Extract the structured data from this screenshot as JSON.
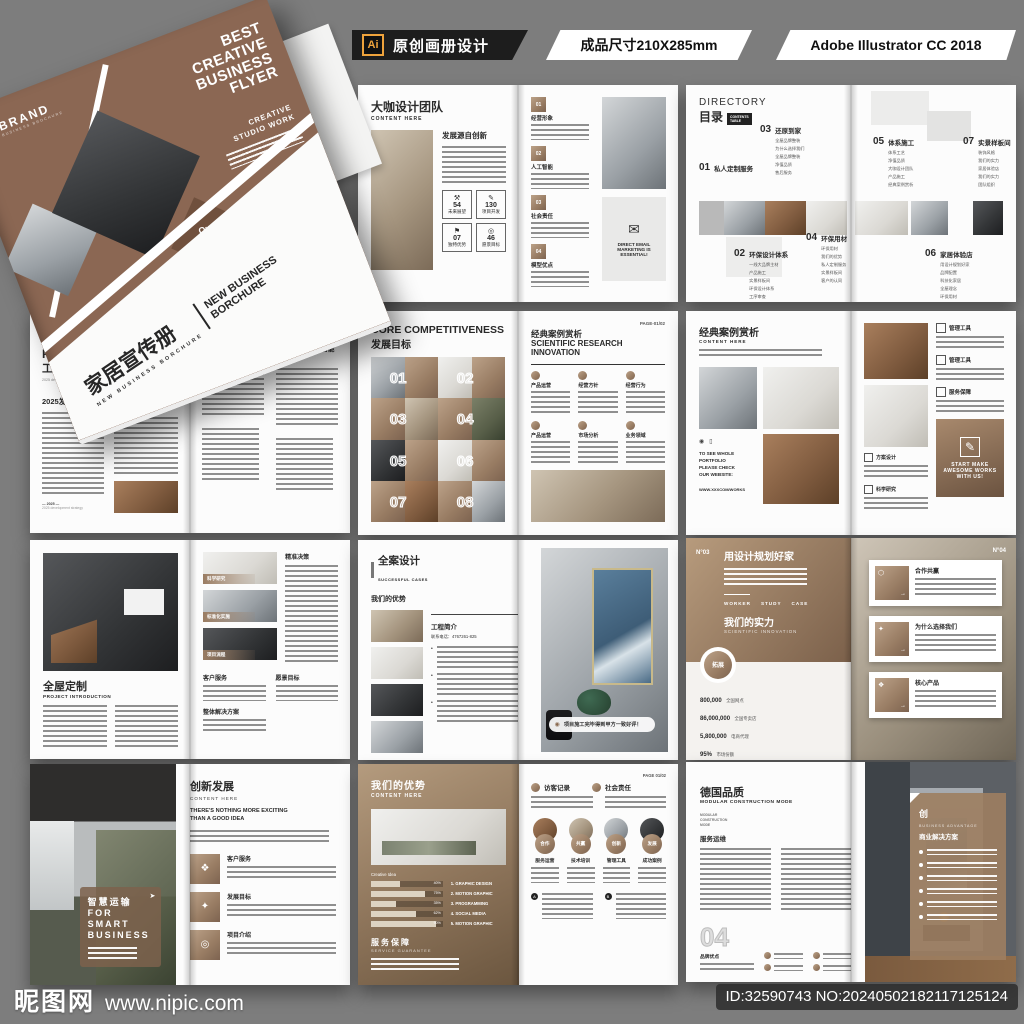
{
  "header": {
    "ai_badge": "Ai",
    "product": "原创画册设计",
    "size": "成品尺寸210X285mm",
    "software": "Adobe Illustrator CC 2018"
  },
  "watermark": {
    "site_name": "昵图网",
    "site_url": "www.nipic.com",
    "image_id": "ID:32590743 NO:20240502182117125124"
  },
  "icons": {
    "hexagon": "⬡",
    "email": "✉",
    "pencil": "✎",
    "tools": "⚒",
    "flag": "⚑",
    "target": "◎",
    "plane": "➤",
    "blocks": "❖",
    "spark": "✦",
    "arrow": "→",
    "camera": "◉",
    "doc": "▯",
    "check": "◉"
  },
  "cover": {
    "brand": "BRAND",
    "brand_sub": "BUSINESS BROCHURE",
    "headline": "BEST\nCREATIVE\nBUSINESS\nFLYER",
    "studio": "CREATIVE\nSTUDIO WORK",
    "service_tag": "Our\nService",
    "title_cn": "家居宣传册",
    "title_en": "NEW BUSINESS BORCHURE",
    "side_title": "NEW BUSINESS\nBORCHURE"
  },
  "team": {
    "title": "大咖设计团队",
    "subtitle": "CONTENT HERE",
    "section": "发展源自创新",
    "stats": [
      {
        "num": "54",
        "label": "未来展望"
      },
      {
        "num": "130",
        "label": "项目开发"
      },
      {
        "num": "07",
        "label": "独特优势"
      },
      {
        "num": "46",
        "label": "愿景目标"
      }
    ],
    "items": [
      {
        "no": "01",
        "label": "经营形象"
      },
      {
        "no": "02",
        "label": "人工智能"
      },
      {
        "no": "03",
        "label": "社会责任"
      },
      {
        "no": "04",
        "label": "模型优点"
      }
    ],
    "email_note": "DIRECT EMAIL\nMARKETING IS\nESSENTIAL!"
  },
  "directory": {
    "title_en": "DIRECTORY",
    "title_cn": "目录",
    "subtitle": "CONTENTS\nTABLE",
    "e01": {
      "no": "01",
      "title": "私人定制服务"
    },
    "e02": {
      "no": "02",
      "title": "环保设计体系",
      "items": [
        "一线大品牌主材",
        "产品施工",
        "实景样板间",
        "环保设计体系",
        "工序审查"
      ]
    },
    "e03": {
      "no": "03",
      "title": "还原到家",
      "items": [
        "全屋品牌整装",
        "为什么选择我们",
        "全屋品牌整装",
        "净值品质",
        "售后服务"
      ]
    },
    "e04": {
      "no": "04",
      "title": "环保用材",
      "items": [
        "环保用材",
        "我们的优势",
        "私人定制服务",
        "实景样板间",
        "客户的认同"
      ]
    },
    "e05": {
      "no": "05",
      "title": "体系施工",
      "items": [
        "体系工艺",
        "净值品质",
        "大咖设计团队",
        "产品施工",
        "经典案例赏析"
      ]
    },
    "e06": {
      "no": "06",
      "title": "家居体验店",
      "items": [
        "用设计规划好家",
        "品牌配置",
        "科技化家居",
        "全屋理念",
        "环保用材"
      ]
    },
    "e07": {
      "no": "07",
      "title": "实景样板间",
      "items": [
        "装饰风格",
        "我们的实力",
        "家居体验店",
        "我们的实力",
        "团队组织"
      ]
    }
  },
  "profile": {
    "brand": "BRAND",
    "title_en": "GROUP\nPROFILE",
    "title_cn": "工业智能",
    "subtitle": "2025 development strategy",
    "h1": "2025发展战略",
    "h2": "经营理念",
    "footer_note": "2025 development strategy",
    "right_h1": "互联网智能世界",
    "right_h2": "构建万物互联的智能世界"
  },
  "core": {
    "title_en": "CORE COMPETITIVENESS",
    "title_cn": "发展目标",
    "numbers": [
      "01",
      "02",
      "03",
      "04",
      "05",
      "06",
      "07",
      "08"
    ],
    "page_no": "PAGE-01/02",
    "right_title_cn": "经典案例赏析",
    "right_title_en": "SCIENTIFIC RESEARCH\nINNOVATION",
    "cells": [
      "产品运营",
      "经营方针",
      "经营行为",
      "产品运营",
      "市场分析",
      "业务领域"
    ]
  },
  "cases": {
    "title": "经典案例赏析",
    "subtitle": "CONTENT HERE",
    "note": "TO SEE WHOLE\nPORTFOLIO\nPLEASE CHECK\nOUR WEBSITE:",
    "site": "WWW.XXXCOM/WORKS",
    "items": [
      "管理工具",
      "管理工具",
      "服务保障"
    ],
    "items2": [
      "方案设计",
      "科学研究"
    ],
    "cta": "START MAKE\nAWESOME WORKS\nWITH US!"
  },
  "project": {
    "title": "全屋定制",
    "subtitle": "PROJECT INTRODUCTION",
    "bands": [
      "科学研究",
      "标准化实施",
      "项目流程"
    ],
    "col": "精准决策",
    "lower": [
      "客户服务",
      "愿景目标"
    ],
    "lower2": "整体解决方案"
  },
  "design": {
    "title": "全案设计",
    "subtitle": "SUCCESSFUL CASES",
    "h": "我们的优势",
    "box_title": "工程简介",
    "phone": "联系电话：4767261-825",
    "caption": "项目施工完毕得到甲方一致好评！"
  },
  "plan": {
    "no_left": "N°03",
    "no_right": "N°04",
    "title": "用设计规划好家",
    "tags": [
      "WORKER",
      "STUDY",
      "CASE"
    ],
    "h": "我们的实力",
    "h_sub": "SCIENTIFIC INNOVATION",
    "badge": "拓展",
    "stats": [
      {
        "value": "800,000",
        "label": "全国网点"
      },
      {
        "value": "86,000,000",
        "label": "全国专卖店"
      },
      {
        "value": "5,800,000",
        "label": "电商代理"
      },
      {
        "value": "95%",
        "label": "市场份额"
      }
    ],
    "cards": [
      "合作共赢",
      "为什么选择我们",
      "核心产品"
    ]
  },
  "smart": {
    "overlay_cn": "智慧运输",
    "overlay_en": "FOR\nSMART\nBUSINESS",
    "title": "创新发展",
    "subtitle": "CONTENT HERE",
    "slogan": "THERE'S NOTHING MORE EXCITING\nTHAN A GOOD IDEA",
    "items": [
      "客户服务",
      "发展目标",
      "项目介绍"
    ]
  },
  "advantage": {
    "title": "我们的优势",
    "subtitle": "CONTENT HERE",
    "creative": "Creative Idea",
    "skills": [
      "1. GRAPHIC DESIGN",
      "2. MOTION GRAPHIC",
      "3. PROGRAMMING",
      "4. SOCIAL MEDIA",
      "5. MOTION GRAPHIC"
    ],
    "bar_labels": [
      "40%",
      "75%",
      "35%",
      "62%",
      "90%"
    ],
    "h2": "服务保障",
    "h2_sub": "SERVICE GUARANTEE",
    "page_no": "PAGE 01/02",
    "heads": [
      "访客记录",
      "社会责任"
    ],
    "circles": [
      {
        "tag": "合作",
        "label": "服务运营"
      },
      {
        "tag": "共赢",
        "label": "技术培训"
      },
      {
        "tag": "创新",
        "label": "管理工具"
      },
      {
        "tag": "发展",
        "label": "成功案例"
      }
    ]
  },
  "quality": {
    "title": "德国品质",
    "subtitle": "MODULAR CONSTRUCTION MODE",
    "small": "MODULAR\nCONSTRUCTION\nMODE",
    "h": "服务运维",
    "big_no": "04",
    "label": "品牌优点",
    "panel_icon": "创",
    "panel_tag": "BUSINESS ADVANTAGE",
    "panel_title": "商业解决方案"
  },
  "colors": {
    "background": "#7d7d7d",
    "cover_brown": "#8b6753",
    "tile_brown": "#9a7d64",
    "header_black": "#1d1d1d",
    "ai_orange": "#efa33c"
  }
}
